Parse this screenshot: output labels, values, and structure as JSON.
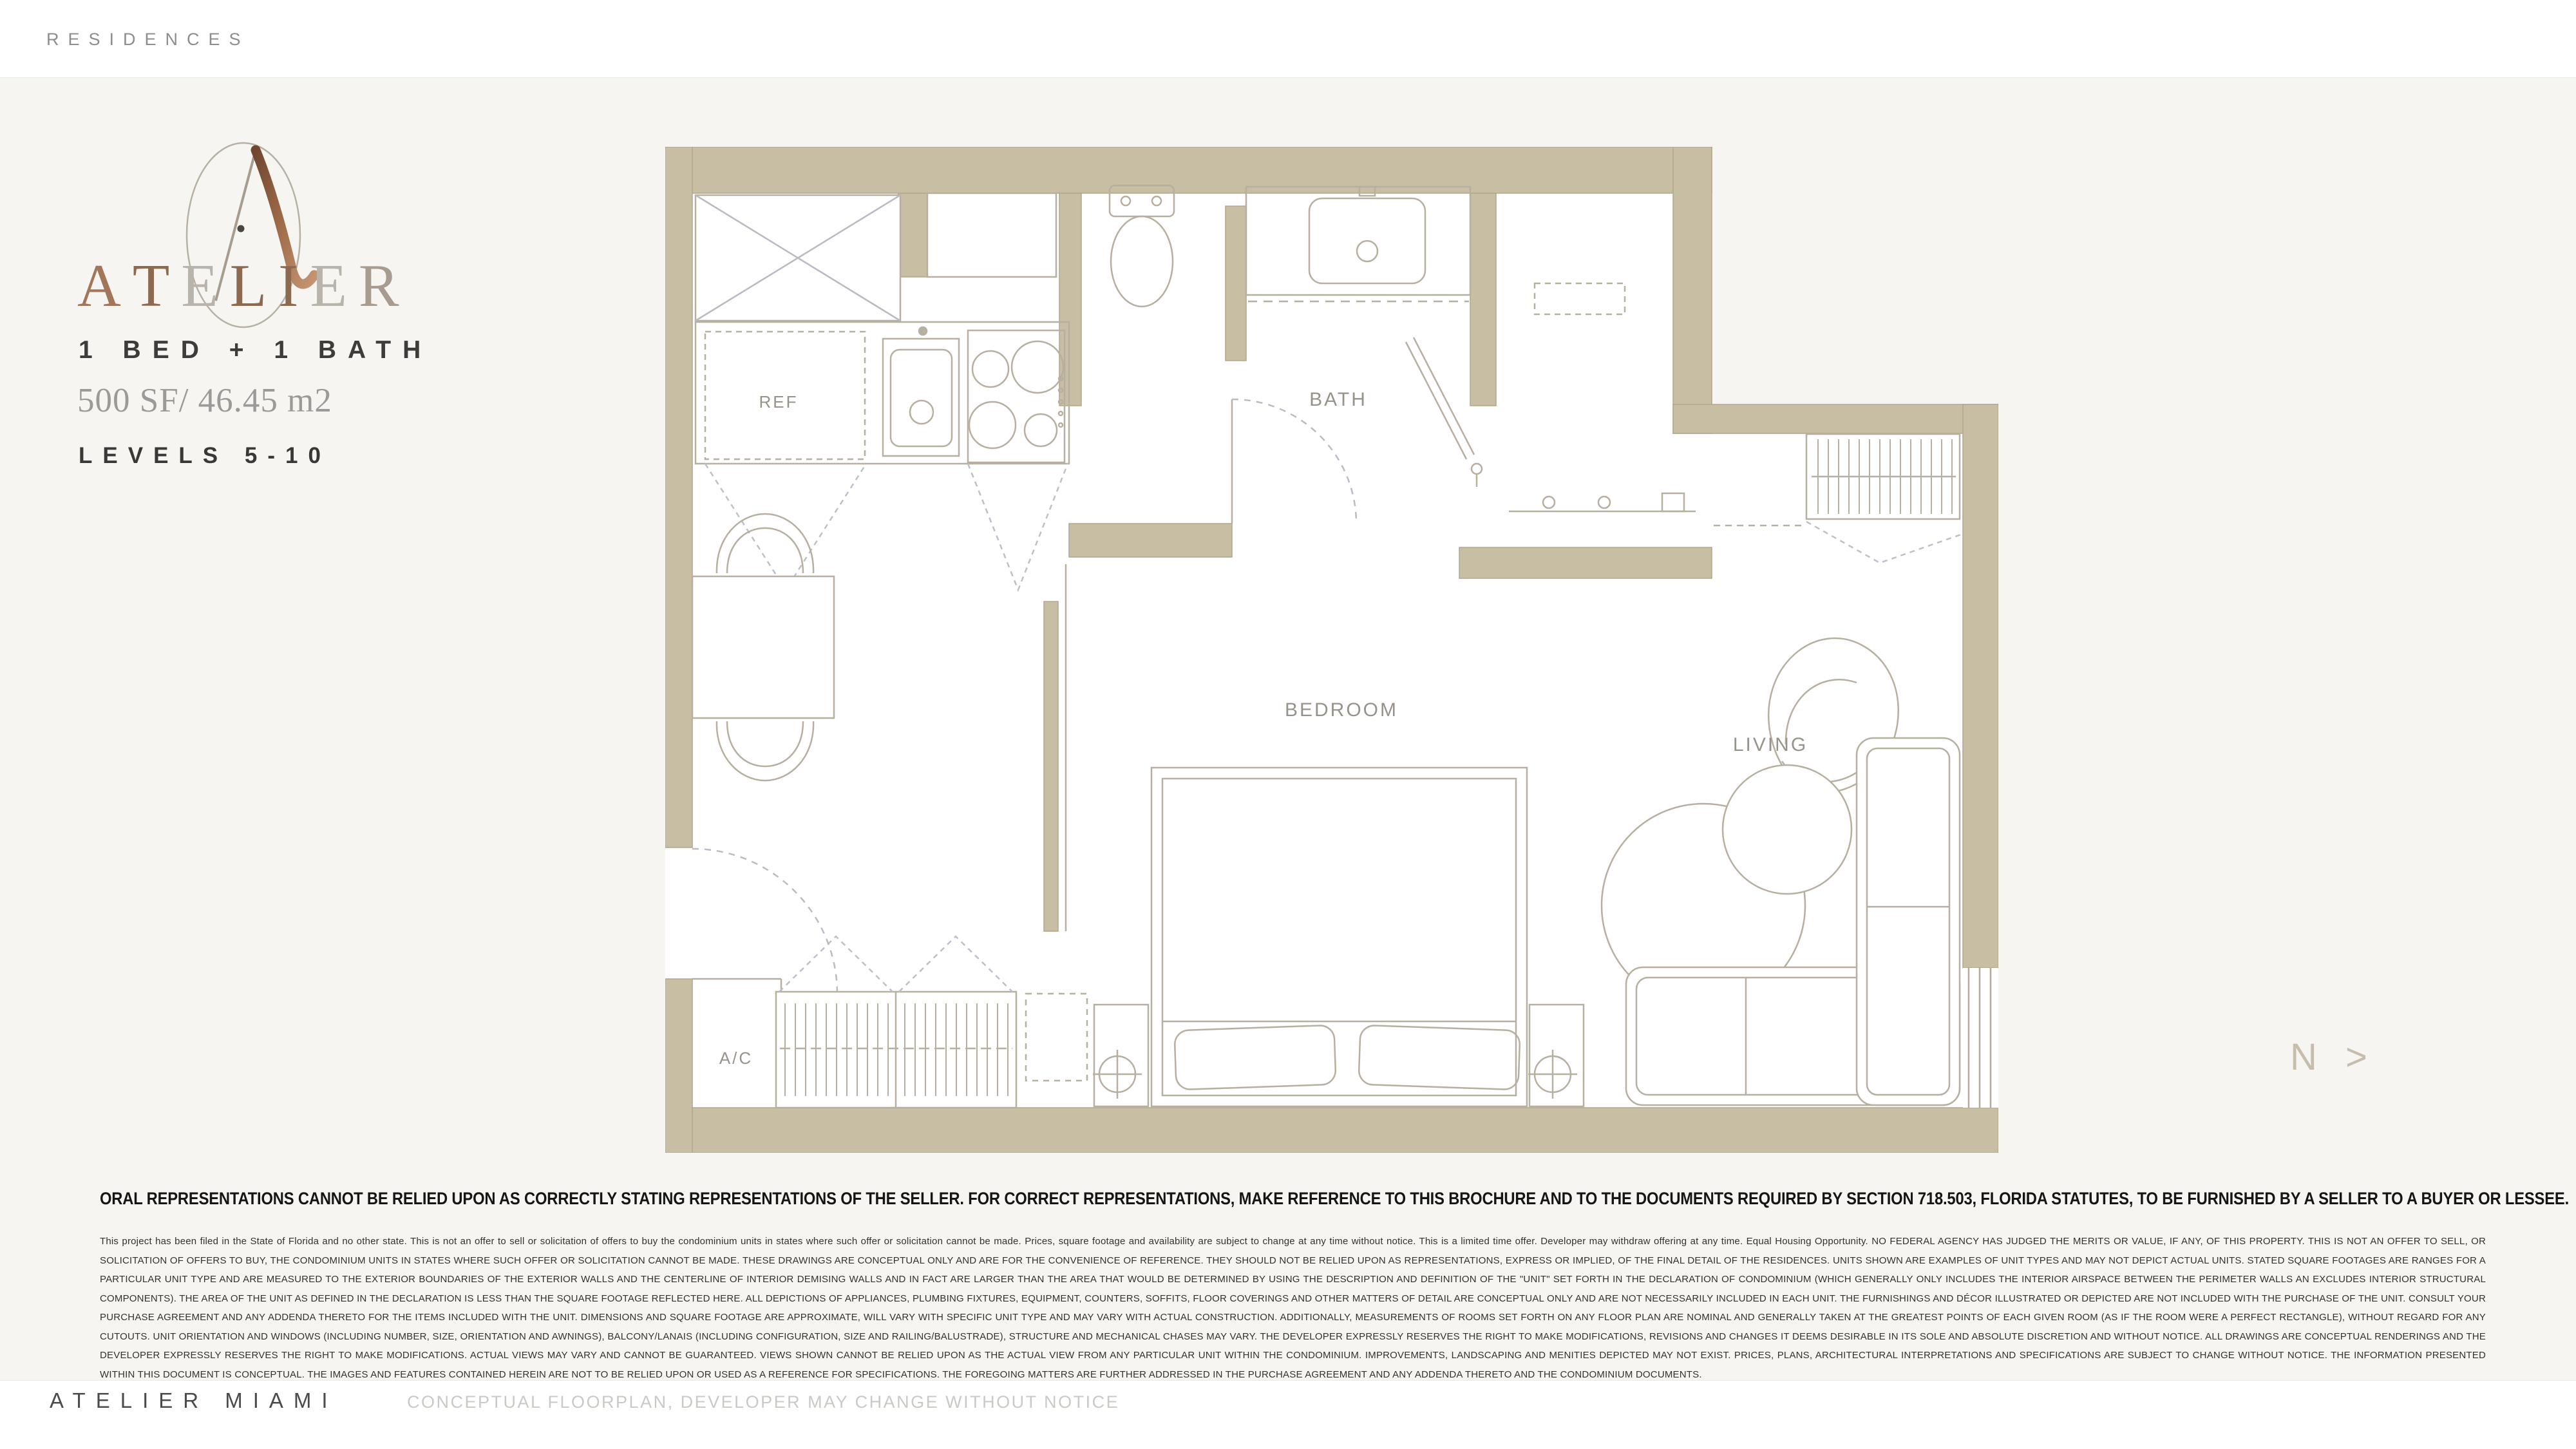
{
  "header": {
    "brand_small": "RESIDENCES"
  },
  "unit": {
    "logo_letters": [
      {
        "ch": "A",
        "color": "#a1765a"
      },
      {
        "ch": "T",
        "color": "#8d6950"
      },
      {
        "ch": "E",
        "color": "#b8b3ab"
      },
      {
        "ch": "L",
        "color": "#8d6950"
      },
      {
        "ch": "I",
        "color": "#8d6950"
      },
      {
        "ch": "E",
        "color": "#b8b3ab"
      },
      {
        "ch": "R",
        "color": "#a89c8e"
      }
    ],
    "type_label": "1 BED + 1 BATH",
    "area_label": "500 SF/ 46.45 m2",
    "levels_label": "LEVELS 5-10"
  },
  "floorplan": {
    "labels": {
      "ref": "REF",
      "bath": "BATH",
      "bedroom": "BEDROOM",
      "living": "LIVING",
      "ac": "A/C"
    },
    "north_label": "N >",
    "wall_color": "#c8bea4",
    "line_color": "#b4ab9c",
    "label_color": "#98938a"
  },
  "legal": {
    "heading": "ORAL REPRESENTATIONS CANNOT BE RELIED UPON AS CORRECTLY STATING REPRESENTATIONS OF THE SELLER. FOR CORRECT REPRESENTATIONS, MAKE REFERENCE TO THIS BROCHURE AND TO THE DOCUMENTS REQUIRED BY SECTION 718.503, FLORIDA STATUTES, TO BE FURNISHED BY A SELLER TO A BUYER OR LESSEE.",
    "intro": "This project has been filed in the State of Florida and no other state. This is not an offer to sell or solicitation of offers to buy the condominium units in states where such offer or solicitation cannot be made. Prices, square footage and availability are subject to change at any time without notice. This is a limited time offer. Developer may withdraw offering at any time. Equal Housing Opportunity. ",
    "body": "NO FEDERAL AGENCY HAS JUDGED THE MERITS OR VALUE, IF ANY, OF THIS PROPERTY. THIS IS NOT AN OFFER TO SELL, OR SOLICITATION OF OFFERS TO BUY, THE CONDOMINIUM UNITS IN STATES WHERE SUCH OFFER OR SOLICITATION CANNOT BE MADE. THESE DRAWINGS ARE CONCEPTUAL ONLY AND ARE FOR THE CONVENIENCE OF REFERENCE. THEY SHOULD NOT BE RELIED UPON AS REPRESENTATIONS, EXPRESS OR IMPLIED, OF THE FINAL DETAIL OF THE RESIDENCES. UNITS SHOWN ARE EXAMPLES OF UNIT TYPES AND MAY NOT DEPICT ACTUAL UNITS. STATED SQUARE FOOTAGES ARE RANGES FOR A PARTICULAR UNIT TYPE AND ARE MEASURED TO THE EXTERIOR BOUNDARIES OF THE EXTERIOR WALLS AND THE CENTERLINE OF INTERIOR DEMISING WALLS AND IN FACT ARE LARGER THAN THE AREA THAT WOULD BE DETERMINED BY USING THE DESCRIPTION AND DEFINITION OF THE \"UNIT\" SET FORTH IN THE DECLARATION OF CONDOMINIUM (WHICH GENERALLY ONLY INCLUDES THE INTERIOR AIRSPACE BETWEEN THE PERIMETER WALLS AN EXCLUDES INTERIOR STRUCTURAL COMPONENTS). THE AREA OF THE UNIT AS DEFINED IN THE DECLARATION IS LESS THAN THE SQUARE FOOTAGE REFLECTED HERE. ALL DEPICTIONS OF APPLIANCES, PLUMBING FIXTURES, EQUIPMENT, COUNTERS, SOFFITS, FLOOR COVERINGS AND OTHER MATTERS OF DETAIL ARE CONCEPTUAL ONLY AND ARE NOT NECESSARILY INCLUDED IN EACH UNIT. THE FURNISHINGS AND DÉCOR ILLUSTRATED OR DEPICTED ARE NOT INCLUDED WITH THE PURCHASE OF THE UNIT. CONSULT YOUR PURCHASE AGREEMENT AND ANY ADDENDA THERETO FOR THE ITEMS INCLUDED WITH THE UNIT. DIMENSIONS AND SQUARE FOOTAGE ARE APPROXIMATE, WILL VARY WITH SPECIFIC UNIT TYPE AND MAY VARY WITH ACTUAL CONSTRUCTION. ADDITIONALLY, MEASUREMENTS OF ROOMS SET FORTH ON ANY FLOOR PLAN ARE NOMINAL AND GENERALLY TAKEN AT THE GREATEST POINTS OF EACH GIVEN ROOM (AS IF THE ROOM WERE A PERFECT RECTANGLE), WITHOUT REGARD FOR ANY CUTOUTS. UNIT ORIENTATION AND WINDOWS (INCLUDING NUMBER, SIZE, ORIENTATION AND AWNINGS), BALCONY/LANAIS (INCLUDING CONFIGURATION, SIZE AND RAILING/BALUSTRADE), STRUCTURE AND MECHANICAL CHASES MAY VARY. THE DEVELOPER EXPRESSLY RESERVES THE RIGHT TO MAKE MODIFICATIONS, REVISIONS AND CHANGES IT DEEMS DESIRABLE IN ITS SOLE AND ABSOLUTE DISCRETION AND WITHOUT NOTICE. ALL DRAWINGS ARE CONCEPTUAL RENDERINGS AND THE DEVELOPER EXPRESSLY RESERVES THE RIGHT TO MAKE MODIFICATIONS. ACTUAL VIEWS MAY VARY AND CANNOT BE GUARANTEED. VIEWS SHOWN CANNOT BE RELIED UPON AS THE ACTUAL VIEW FROM ANY PARTICULAR UNIT WITHIN THE CONDOMINIUM. IMPROVEMENTS, LANDSCAPING AND MENITIES DEPICTED MAY NOT EXIST. PRICES, PLANS, ARCHITECTURAL INTERPRETATIONS AND SPECIFICATIONS ARE SUBJECT TO CHANGE WITHOUT NOTICE. THE INFORMATION PRESENTED WITHIN THIS DOCUMENT IS CONCEPTUAL. THE IMAGES AND FEATURES CONTAINED HEREIN ARE NOT TO BE RELIED UPON OR USED AS A REFERENCE FOR SPECIFICATIONS. THE FOREGOING MATTERS ARE FURTHER ADDRESSED IN THE PURCHASE AGREEMENT AND ANY ADDENDA THERETO AND THE CONDOMINIUM DOCUMENTS."
  },
  "footer": {
    "brand": "ATELIER MIAMI",
    "note": "CONCEPTUAL FLOORPLAN, DEVELOPER MAY CHANGE WITHOUT NOTICE"
  }
}
